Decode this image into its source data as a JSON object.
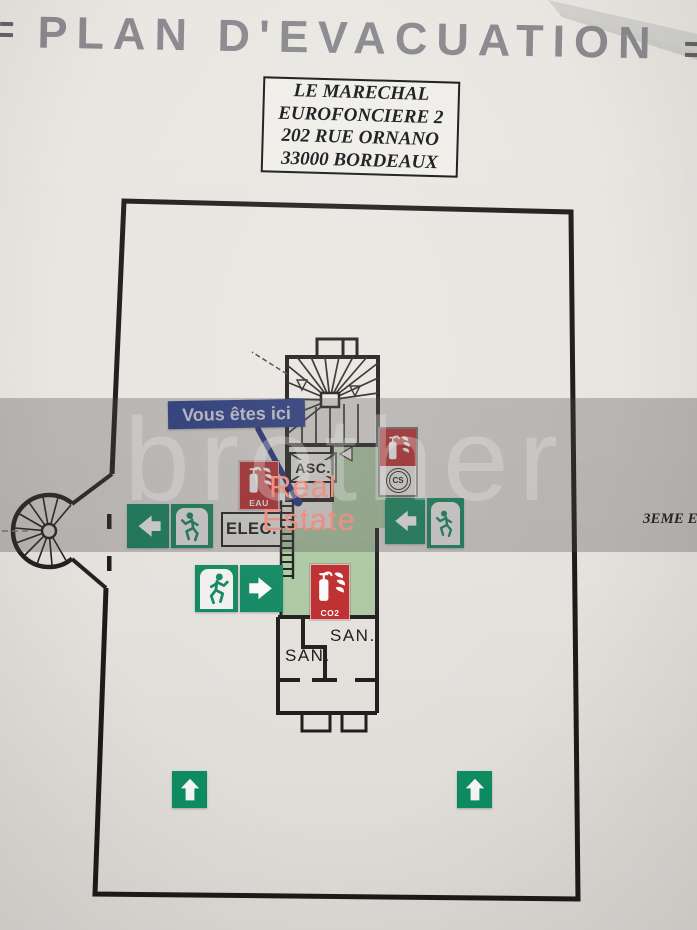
{
  "title": "PLAN D'EVACUATION",
  "address": {
    "lines": [
      "LE MARECHAL",
      "EUROFONCIERE 2",
      "202 RUE ORNANO",
      "33000 BORDEAUX"
    ]
  },
  "floor": {
    "label": "3EME E"
  },
  "you_are_here": {
    "label": "Vous êtes ici"
  },
  "rooms": {
    "elevator": "ASC.",
    "electrical": "ELEC.",
    "sanitary_left": "SAN.",
    "sanitary_right": "SAN."
  },
  "safety_signs": {
    "extinguisher_water": "EAU",
    "extinguisher_co2": "CO2",
    "extinguisher_cs": "CS"
  },
  "watermark": {
    "brand": "brother",
    "line1": "Real",
    "line2": "Estate"
  },
  "colors": {
    "exit_green": "#0e8a62",
    "safety_red": "#c0292a",
    "here_blue": "#233a8e",
    "room_green": "#aecba4",
    "watermark_salmon": "#f0897c",
    "title_gray": "#87868b",
    "wall_black": "#1d1c1a"
  }
}
